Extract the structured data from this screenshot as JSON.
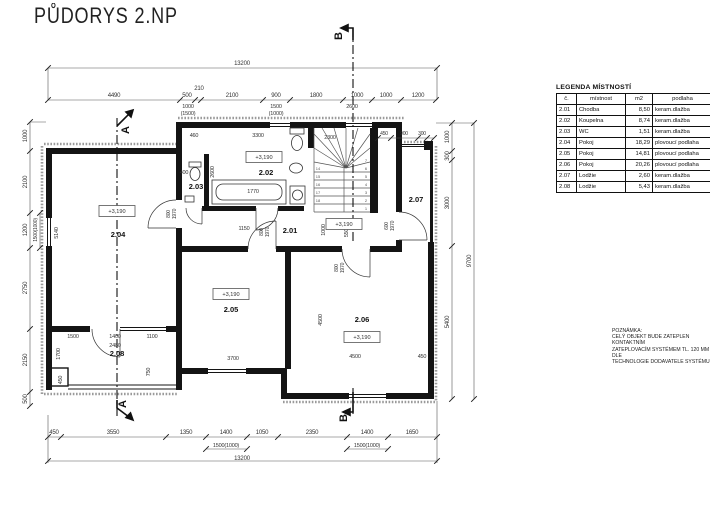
{
  "title": "PŮDORYS 2.NP",
  "legend": {
    "title": "LEGENDA MÍSTNOSTÍ",
    "headers": [
      "č.",
      "místnost",
      "m2",
      "podlaha"
    ],
    "rows": [
      [
        "2.01",
        "Chodba",
        "8,50",
        "keram.dlažba"
      ],
      [
        "2.02",
        "Koupelna",
        "8,74",
        "keram.dlažba"
      ],
      [
        "2.03",
        "WC",
        "1,51",
        "keram.dlažba"
      ],
      [
        "2.04",
        "Pokoj",
        "18,29",
        "plovoucí podlaha"
      ],
      [
        "2.05",
        "Pokoj",
        "14,81",
        "plovoucí podlaha"
      ],
      [
        "2.06",
        "Pokoj",
        "20,26",
        "plovoucí podlaha"
      ],
      [
        "2.07",
        "Lodžie",
        "2,60",
        "keram.dlažba"
      ],
      [
        "2.08",
        "Lodžie",
        "5,43",
        "keram.dlažba"
      ]
    ]
  },
  "note": {
    "heading": "POZNÁMKA:",
    "lines": [
      "CELÝ OBJEKT BUDE ZATEPLEN KONTAKTNÍM",
      "ZATEPLOVACÍM SYSTÉMEM TL. 120 MM DLE",
      "TECHNOLOGIE DODAVATELE SYSTÉMU"
    ]
  },
  "sections": {
    "a": "A",
    "b": "B"
  },
  "level_text": "+3,190",
  "line_colors": {
    "wall": "#141414",
    "dim": "#444",
    "hatch": "#9a9a9a"
  },
  "rooms": [
    {
      "id": "2.01",
      "x": 290,
      "y": 233,
      "lx": 344,
      "ly": 224
    },
    {
      "id": "2.02",
      "x": 266,
      "y": 175,
      "lx": 264,
      "ly": 157
    },
    {
      "id": "2.03",
      "x": 196,
      "y": 189
    },
    {
      "id": "2.04",
      "x": 118,
      "y": 237,
      "lx": 117,
      "ly": 211
    },
    {
      "id": "2.05",
      "x": 231,
      "y": 312,
      "lx": 231,
      "ly": 294
    },
    {
      "id": "2.06",
      "x": 362,
      "y": 322,
      "lx": 362,
      "ly": 337
    },
    {
      "id": "2.07",
      "x": 416,
      "y": 202
    },
    {
      "id": "2.08",
      "x": 117,
      "y": 356
    }
  ],
  "stair_numbers": {
    "right": [
      "1",
      "2",
      "3",
      "4",
      "5",
      "6",
      "7"
    ],
    "left": [
      "14",
      "15",
      "16",
      "17",
      "18"
    ]
  },
  "dims": [
    {
      "t": "13200",
      "x": 242,
      "y": 65
    },
    {
      "t": "4490",
      "x": 114,
      "y": 97
    },
    {
      "t": "500",
      "x": 187,
      "y": 97
    },
    {
      "t": "210",
      "x": 199,
      "y": 90
    },
    {
      "t": "2100",
      "x": 232,
      "y": 97
    },
    {
      "t": "900",
      "x": 276,
      "y": 97
    },
    {
      "t": "1800",
      "x": 316,
      "y": 97
    },
    {
      "t": "1000",
      "x": 357,
      "y": 97
    },
    {
      "t": "1000",
      "x": 386,
      "y": 97
    },
    {
      "t": "1200",
      "x": 418,
      "y": 97
    },
    {
      "t": "1000",
      "x": 188,
      "y": 108,
      "s": 5.5
    },
    {
      "t": "(1500)",
      "x": 188,
      "y": 115,
      "s": 5.5
    },
    {
      "t": "1500",
      "x": 276,
      "y": 108,
      "s": 5.5
    },
    {
      "t": "(1000)",
      "x": 276,
      "y": 115,
      "s": 5.5
    },
    {
      "t": "2600",
      "x": 352,
      "y": 108,
      "s": 5.5
    },
    {
      "t": "450",
      "x": 54,
      "y": 434
    },
    {
      "t": "3550",
      "x": 113,
      "y": 434
    },
    {
      "t": "1350",
      "x": 186,
      "y": 434
    },
    {
      "t": "1400",
      "x": 226,
      "y": 434
    },
    {
      "t": "1050",
      "x": 262,
      "y": 434
    },
    {
      "t": "2350",
      "x": 312,
      "y": 434
    },
    {
      "t": "1400",
      "x": 367,
      "y": 434
    },
    {
      "t": "1650",
      "x": 412,
      "y": 434
    },
    {
      "t": "1500(1000)",
      "x": 226,
      "y": 447,
      "s": 5.5
    },
    {
      "t": "1500(1000)",
      "x": 367,
      "y": 447,
      "s": 5.5
    },
    {
      "t": "13200",
      "x": 242,
      "y": 460
    },
    {
      "t": "1000",
      "x": 27,
      "y": 136,
      "r": -90
    },
    {
      "t": "2100",
      "x": 27,
      "y": 182,
      "r": -90
    },
    {
      "t": "1200",
      "x": 27,
      "y": 230,
      "r": -90
    },
    {
      "t": "1500(1000)",
      "x": 37,
      "y": 230,
      "r": -90,
      "s": 5
    },
    {
      "t": "2750",
      "x": 27,
      "y": 288,
      "r": -90
    },
    {
      "t": "2150",
      "x": 27,
      "y": 360,
      "r": -90
    },
    {
      "t": "500",
      "x": 27,
      "y": 399,
      "r": -90
    },
    {
      "t": "1000",
      "x": 449,
      "y": 137,
      "r": -90
    },
    {
      "t": "300",
      "x": 449,
      "y": 156,
      "r": -90
    },
    {
      "t": "3000",
      "x": 449,
      "y": 203,
      "r": -90
    },
    {
      "t": "5400",
      "x": 449,
      "y": 322,
      "r": -90
    },
    {
      "t": "9700",
      "x": 471,
      "y": 261,
      "r": -90
    },
    {
      "t": "450",
      "x": 384,
      "y": 135,
      "s": 5
    },
    {
      "t": "900",
      "x": 404,
      "y": 135,
      "s": 5
    },
    {
      "t": "300",
      "x": 422,
      "y": 135,
      "s": 5
    },
    {
      "t": "5140",
      "x": 58,
      "y": 233,
      "r": -90,
      "s": 5.5
    },
    {
      "t": "3300",
      "x": 258,
      "y": 137,
      "s": 5.5
    },
    {
      "t": "2600",
      "x": 214,
      "y": 172,
      "r": -90,
      "s": 5.5
    },
    {
      "t": "1770",
      "x": 253,
      "y": 193,
      "s": 5.5
    },
    {
      "t": "2300",
      "x": 330,
      "y": 139,
      "s": 5.5
    },
    {
      "t": "1150",
      "x": 244,
      "y": 230,
      "s": 5.5
    },
    {
      "t": "1000",
      "x": 325,
      "y": 230,
      "r": -90,
      "s": 5.5
    },
    {
      "t": "550",
      "x": 348,
      "y": 233,
      "r": -90,
      "s": 5.5
    },
    {
      "t": "4500",
      "x": 322,
      "y": 320,
      "r": -90,
      "s": 5.5
    },
    {
      "t": "4500",
      "x": 355,
      "y": 358,
      "s": 5.5
    },
    {
      "t": "450",
      "x": 422,
      "y": 358,
      "s": 5.5
    },
    {
      "t": "3700",
      "x": 233,
      "y": 360,
      "s": 5.5
    },
    {
      "t": "1500",
      "x": 73,
      "y": 338,
      "s": 5.5
    },
    {
      "t": "1400",
      "x": 115,
      "y": 338,
      "s": 5.5
    },
    {
      "t": "1100",
      "x": 152,
      "y": 338,
      "s": 5.5
    },
    {
      "t": "2480",
      "x": 115,
      "y": 347,
      "s": 5.5
    },
    {
      "t": "1700",
      "x": 60,
      "y": 354,
      "r": -90,
      "s": 5.5
    },
    {
      "t": "750",
      "x": 150,
      "y": 372,
      "r": -90,
      "s": 5.5
    },
    {
      "t": "450",
      "x": 62,
      "y": 380,
      "r": -90,
      "s": 5.5
    },
    {
      "t": "460",
      "x": 194,
      "y": 137,
      "s": 5.5
    },
    {
      "t": "400",
      "x": 184,
      "y": 174,
      "s": 5.5
    },
    {
      "t": "600",
      "x": 388,
      "y": 226,
      "r": -90,
      "s": 5
    },
    {
      "t": "1970",
      "x": 394,
      "y": 226,
      "r": -90,
      "s": 5
    },
    {
      "t": "800",
      "x": 263,
      "y": 232,
      "r": -90,
      "s": 5
    },
    {
      "t": "1970",
      "x": 269,
      "y": 232,
      "r": -90,
      "s": 5
    },
    {
      "t": "800",
      "x": 170,
      "y": 214,
      "r": -90,
      "s": 5
    },
    {
      "t": "1970",
      "x": 176,
      "y": 214,
      "r": -90,
      "s": 5
    },
    {
      "t": "800",
      "x": 338,
      "y": 268,
      "r": -90,
      "s": 5
    },
    {
      "t": "1970",
      "x": 344,
      "y": 268,
      "r": -90,
      "s": 5
    }
  ]
}
